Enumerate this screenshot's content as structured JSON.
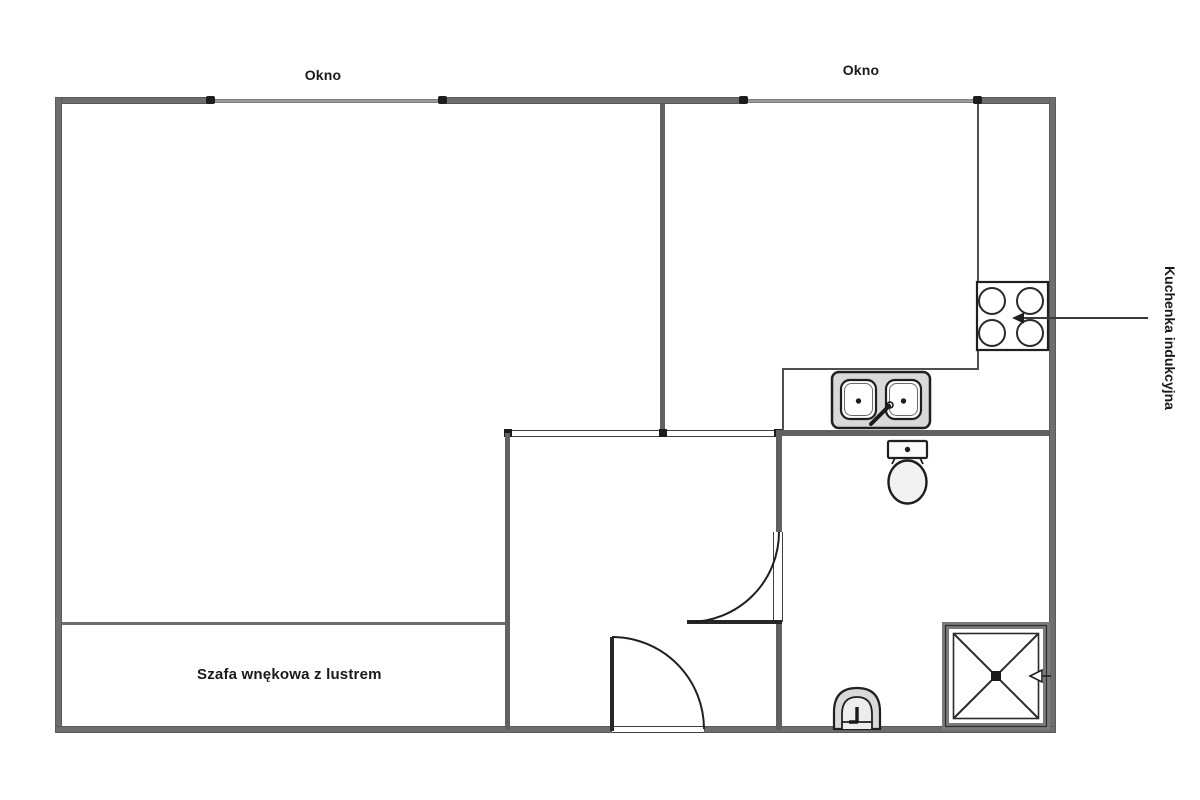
{
  "labels": {
    "window_left": "Okno",
    "window_right": "Okno",
    "wardrobe": "Szafa wnękowa z lustrem",
    "cooktop_annotation": "Kuchenka indukcyjna"
  },
  "icons": {
    "cooktop": "induction-cooktop-4-burners",
    "sink": "double-kitchen-sink-with-faucet",
    "toilet": "toilet-top-view",
    "washbasin": "washbasin-top-view",
    "shower": "shower-tray-with-drain",
    "doors": "quarter-arc-door-swing",
    "annotation_arrow": "left-pointing-arrow"
  },
  "colors": {
    "background": "#ffffff",
    "wall": "#6e6e6e",
    "interior_wall": "#616161",
    "window_line": "#9b9b9b",
    "fixture_outline": "#1f1f1f",
    "fixture_fill": "#d9d9d9",
    "text": "#1a1a1a"
  }
}
